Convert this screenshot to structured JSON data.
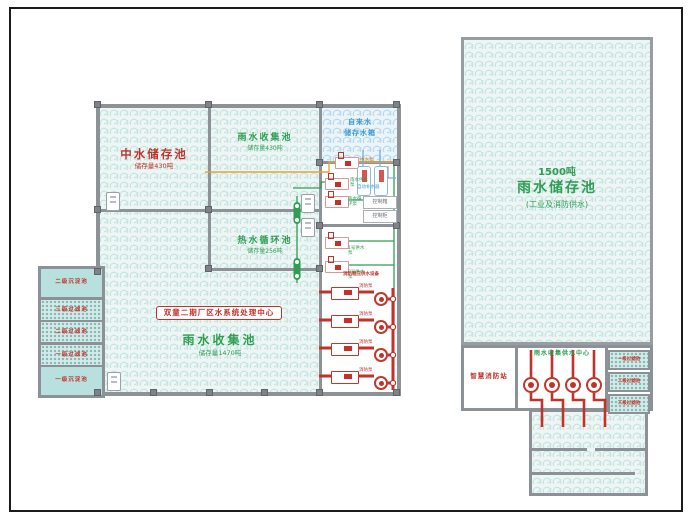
{
  "colors": {
    "red": "#c2322b",
    "green": "#2f9e53",
    "blue": "#3e9bd6",
    "orange": "#e0a43c",
    "wall": "#8d9296"
  },
  "left_building": {
    "rooms": {
      "zhongshui": {
        "name": "中水储存池",
        "sub": "储存量430吨"
      },
      "rain_collect_small": {
        "name": "雨水收集池",
        "sub": "储存量430吨"
      },
      "hot_cycle": {
        "name": "热水循环池",
        "sub": "储存量256吨"
      },
      "main_pool": {
        "name": "雨水收集池",
        "sub": "储存量1470吨"
      },
      "tap_tank": {
        "line1": "自来水",
        "line2": "储存水箱"
      }
    },
    "center_badge": "双童二期厂区水系统处理中心",
    "side_tanks": [
      "二级沉淀池",
      "三级过滤池",
      "二级过滤池",
      "一级过滤池",
      "一级沉淀池"
    ],
    "equipment": {
      "pump_labels": [
        "中水泵",
        "雨水供水泵",
        "热水循环泵",
        "1号供水泵",
        "2号供水泵"
      ],
      "tank_label": "自动补水器",
      "control_boxes": [
        "控制箱",
        "控制柜"
      ],
      "fire_header": "消防稳压供水设备",
      "fire_pump_label": "消防泵"
    }
  },
  "right_area": {
    "pool": {
      "tonnage": "1500吨",
      "name": "雨水储存池",
      "sub": "(工业及消防供水)"
    },
    "station": {
      "fire_station": "智慧消防站",
      "supply_center": "雨水收集供水中心"
    },
    "filters": [
      "一级过滤池",
      "二级过滤池",
      "三级过滤池"
    ]
  }
}
